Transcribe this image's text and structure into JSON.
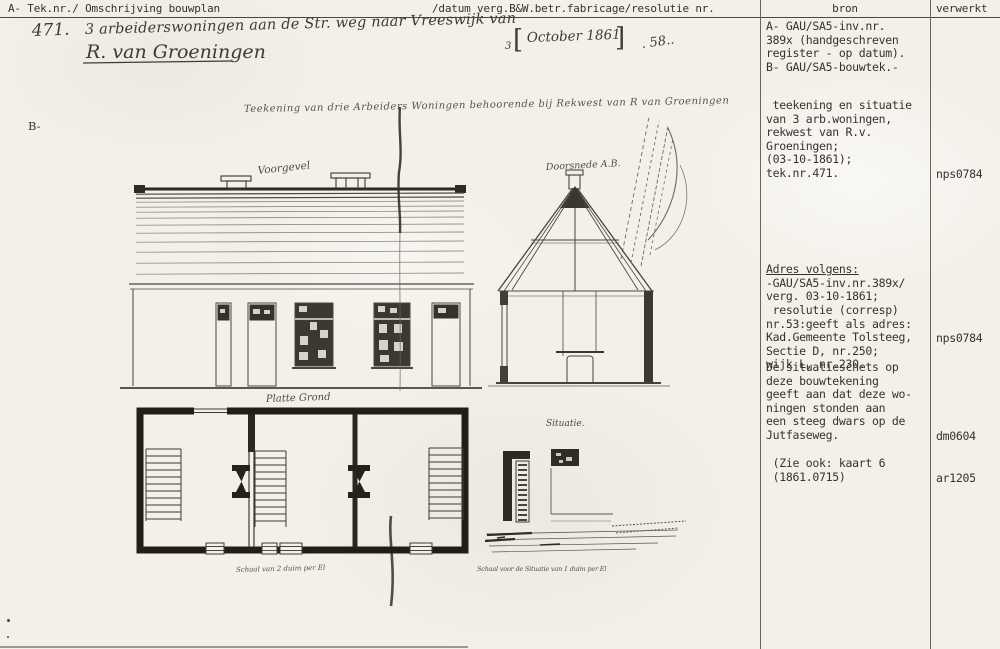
{
  "header": {
    "left": "A- Tek.nr./ Omschrijving bouwplan",
    "middle": "/datum verg.B&W.betr.fabricage/resolutie nr.",
    "bron": "bron",
    "verwerkt": "verwerkt"
  },
  "handwriting": {
    "number": "471.",
    "line1": "3 arbeiderswoningen aan de Str. weg naar Vreeswijk van",
    "line2": "R. van Groeningen",
    "date_prefix": "3",
    "date_bracket_left": "[",
    "date_text": "October 1861",
    "date_bracket_right": "]",
    "trailing_mark": ". 58.."
  },
  "margin_label": "B-",
  "drawing": {
    "title": "Teekening van drie Arbeiders Woningen behoorende bij Rekwest van R van Groeningen",
    "labels": {
      "facade": "Voorgevel",
      "section": "Doorsnede A.B.",
      "plan": "Platte Grond",
      "situation": "Situatie.",
      "plan_scale": "Schaal van 2 duim per El",
      "situation_scale": "Schaal voor de Situatie van 1 duim per El"
    }
  },
  "bron_column": {
    "block1": [
      "A- GAU/SA5-inv.nr.",
      "389x (handgeschreven",
      "register - op datum).",
      "B- GAU/SA5-bouwtek.-"
    ],
    "block2": [
      " teekening en situatie",
      "van 3 arb.woningen,",
      "rekwest van R.v.",
      "Groeningen;",
      "(03-10-1861);",
      "tek.nr.471."
    ],
    "block3_title": "Adres volgens:",
    "block3_lines": [
      "-GAU/SA5-inv.nr.389x/",
      "verg. 03-10-1861;",
      " resolutie (corresp)",
      "nr.53:geeft als adres:",
      "Kad.Gemeente Tolsteeg,",
      "Sectie D, nr.250;",
      "wijk L, nr.230."
    ],
    "block4": [
      "De situatieschets op",
      "deze bouwtekening",
      "geeft aan dat deze wo-",
      "ningen stonden aan",
      "een steeg dwars op de",
      "Jutfaseweg."
    ],
    "block5": [
      " (Zie ook: kaart 6",
      " (1861.0715)"
    ]
  },
  "verwerkt_column": {
    "entries": [
      "nps0784",
      "nps0784",
      "dm0604",
      "ar1205"
    ]
  },
  "colors": {
    "paper": "#f3f0e9",
    "ink_dark": "#2e2b26",
    "ink_mid": "#4a463f",
    "typewriter": "#35322c"
  }
}
